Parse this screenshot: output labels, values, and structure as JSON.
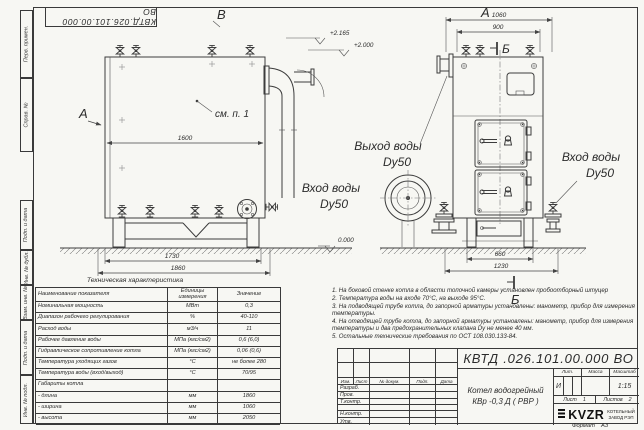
{
  "stamp_top": "КВТД.026.101.00.000  ВО",
  "frame": {
    "margin_labels": [
      "Перв. примен.",
      "Справ. №",
      "Подп. и дата",
      "Инв. № дубл.",
      "Взам. инв. №",
      "Подп. и дата",
      "Инв. № подл."
    ],
    "format_label": "Формат",
    "format_value": "А3"
  },
  "drawing": {
    "view_labels": {
      "top_left": "В",
      "top_right": "А",
      "side": "А",
      "section_top": "Б",
      "section_bottom": "Б"
    },
    "callout": "см. п. 1",
    "dims": {
      "body_length": "1600",
      "support_span": "1730",
      "overall_length": "1860",
      "overall_depth": "1060",
      "top_span": "900",
      "leg_span": "660",
      "overall_depth_bottom": "1230"
    },
    "elevations": {
      "stack_top": "+2.165",
      "boiler_top": "+2.000",
      "ground": "0.000"
    },
    "port_labels": {
      "outlet_line1": "Выход воды",
      "outlet_line2": "Dy50",
      "inlet_front_line1": "Вход воды",
      "inlet_front_line2": "Dy50",
      "inlet_side_line1": "Вход воды",
      "inlet_side_line2": "Dy50"
    }
  },
  "tech_table": {
    "title": "Техническая характеристика",
    "col_headers": [
      "Наименование показателя",
      "Единицы измерения",
      "Значение"
    ],
    "rows": [
      [
        "Номинальная мощность",
        "МВт",
        "0,3"
      ],
      [
        "Диапазон рабочего регулирования",
        "%",
        "40-110"
      ],
      [
        "Расход воды",
        "м3/ч",
        "11"
      ],
      [
        "Рабочее давление воды",
        "МПа (кгс/см2)",
        "0,6 (6,0)"
      ],
      [
        "Гидравлическое сопротивление котла",
        "МПа (кгс/см2)",
        "0,06 (0,6)"
      ],
      [
        "Температура уходящих газов",
        "°С",
        "не более 280"
      ],
      [
        "Температура воды (вход/выход)",
        "°С",
        "70/95"
      ],
      [
        "Габариты котла",
        "",
        ""
      ],
      [
        "- длина",
        "мм",
        "1860"
      ],
      [
        "- ширина",
        "мм",
        "1060"
      ],
      [
        "- высота",
        "мм",
        "2050"
      ]
    ]
  },
  "notes": [
    "1.  На боковой стенке котла в области топочной камеры установлен пробоотборный штуцер",
    "2.  Температура воды на входе 70°С, на выходе 95°С.",
    "3.  На подводящей трубе котла, до запорной арматуры установлены: манометр, прибор для измерения температуры.",
    "4.  На отводящей трубе котла, до запорной арматуры установлены: манометр, прибор для измерения температуры и два предохранительных клапана  Dу не менее 40 мм.",
    "5.  Остальные технические требования по ОСТ 108.030.133-84."
  ],
  "title_block": {
    "doc_number": "КВТД .026.101.00.000  ВО",
    "product_name_line1": "Котел водогрейный",
    "product_name_line2": "КВр -0,3  Д  ( РВР )",
    "header_cells": [
      "Изм.",
      "Лист",
      "№ докум.",
      "Подп.",
      "Дата"
    ],
    "row_labels": [
      "Разраб.",
      "Пров.",
      "Т.контр.",
      "Н.контр.",
      "Утв."
    ],
    "lit_label": "Лит.",
    "mass_label": "Масса",
    "scale_label": "Масштаб",
    "lit_value": "И",
    "scale_value": "1:15",
    "sheet_label": "Лист",
    "sheet_value": "1",
    "sheets_label": "Листов",
    "sheets_value": "2",
    "company_logo": "KVZR",
    "company_name_line1": "КОТЕЛЬНЫЙ",
    "company_name_line2": "ЗАВОД РЭП"
  }
}
